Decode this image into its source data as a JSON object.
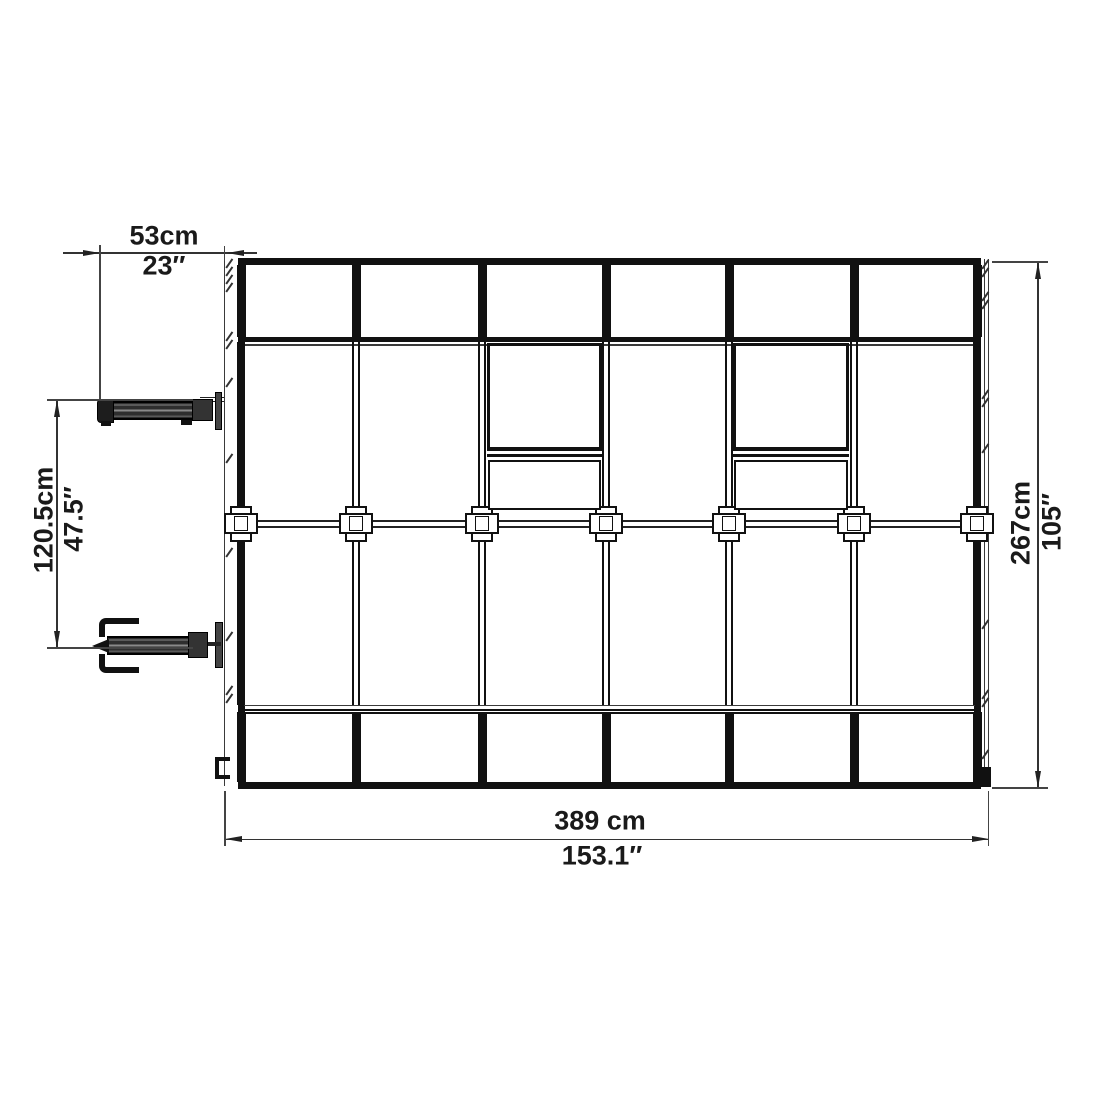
{
  "dimensions": {
    "top": {
      "metric": "53cm",
      "imperial": "23″"
    },
    "left": {
      "metric": "120.5cm",
      "imperial": "47.5″"
    },
    "right": {
      "metric": "267cm",
      "imperial": "105″"
    },
    "bottom": {
      "metric": "389 cm",
      "imperial": "153.1″"
    }
  },
  "structure": {
    "panel_columns": 6,
    "roof_vents": 2,
    "window_openers": 2,
    "hub_connectors": 7
  },
  "colors": {
    "line": "#111111",
    "dimension_line": "#333333",
    "background": "#ffffff"
  }
}
